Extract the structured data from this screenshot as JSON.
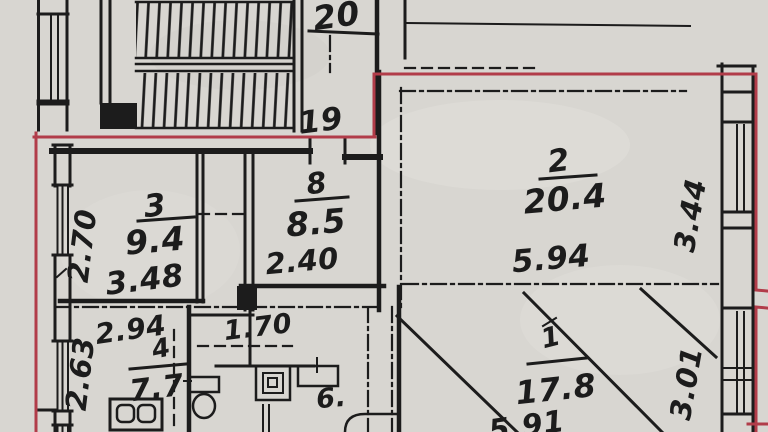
{
  "colors": {
    "paper": "#d8d6d1",
    "ink": "#1c1c1c",
    "red": "#b13c49"
  },
  "stair": {
    "upper": "20",
    "lower": "19"
  },
  "rooms": {
    "r3": {
      "num": "3",
      "area": "9.4",
      "width": "3.48",
      "height": "2.70"
    },
    "r8": {
      "num": "8",
      "area": "8.5",
      "width": "2.40"
    },
    "r2": {
      "num": "2",
      "area": "20.4",
      "width": "5.94",
      "height": "3.44"
    },
    "r4": {
      "num": "4",
      "area": "7.7",
      "width": "2.94",
      "height": "2.63"
    },
    "r1": {
      "num": "1",
      "area": "17.8",
      "width": "5.91",
      "height": "3.01"
    },
    "r6": {
      "num": "6."
    }
  },
  "dims": {
    "hall": "1.70"
  }
}
